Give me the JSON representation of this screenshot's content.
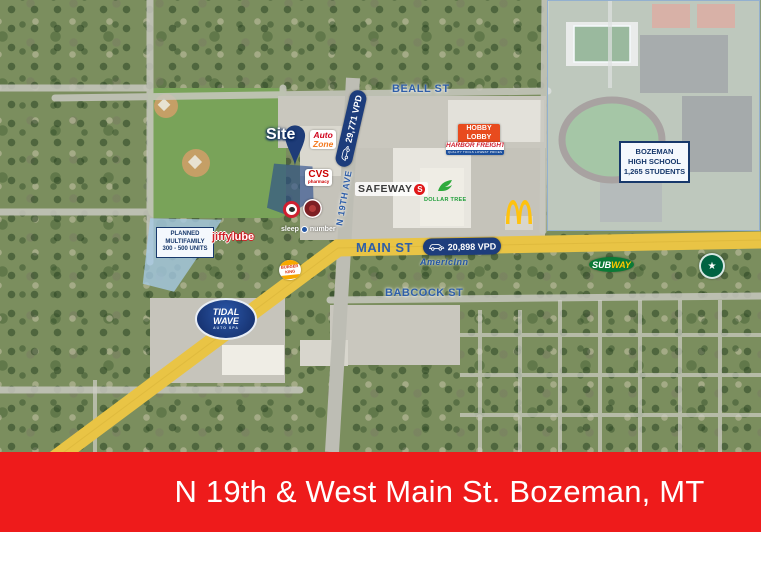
{
  "banner": {
    "title": "N 19th & West Main St. Bozeman, MT"
  },
  "streets": {
    "beall": "BEALL ST",
    "main": "MAIN ST",
    "babcock": "BABCOCK ST",
    "n19th": "N 19TH AVE"
  },
  "traffic": {
    "n19th_vpd": "29,771 VPD",
    "main_vpd": "20,898 VPD"
  },
  "site": {
    "label": "Site"
  },
  "callouts": {
    "multifamily": {
      "line1": "PLANNED",
      "line2": "MULTIFAMILY",
      "line3": "300 - 500 UNITS"
    },
    "high_school": {
      "line1": "BOZEMAN",
      "line2": "HIGH SCHOOL",
      "line3": "1,265 STUDENTS"
    }
  },
  "logos": {
    "autozone": {
      "top": "Auto",
      "bottom": "Zone"
    },
    "cvs": {
      "top": "CVS",
      "bottom": "pharmacy"
    },
    "safeway": {
      "name": "SAFEWAY",
      "initial": "S"
    },
    "dollar_tree": {
      "name": "DOLLAR TREE"
    },
    "hobby_lobby": {
      "line1": "HOBBY",
      "line2": "LOBBY"
    },
    "harbor_freight": {
      "name": "HARBOR FREIGHT",
      "tagline": "QUALITY TOOLS  LOWEST PRICES"
    },
    "jiffy_lube": {
      "part1": "jiffy",
      "part2": "lube"
    },
    "sleep_number": {
      "part1": "sleep",
      "part2": "number"
    },
    "burger_king": {
      "line1": "BURGER",
      "line2": "KING"
    },
    "subway": {
      "part1": "SUB",
      "part2": "WAY"
    },
    "tidal_wave": {
      "line1": "TIDAL",
      "line2": "WAVE",
      "line3": "AUTO SPA"
    },
    "americinn": {
      "name": "AmericInn"
    }
  },
  "icons": {
    "traffic_badge": "car-icon",
    "site_marker": "map-pin-icon",
    "mcdonalds": "golden-arches-icon",
    "starbucks": "siren-circle-icon",
    "panda_express": "red-ring-restaurant-icon",
    "chipotle": "red-medallion-restaurant-icon",
    "dollar_tree": "green-tree-icon",
    "sleep_number": "blue-circle-icon"
  },
  "colors": {
    "banner_red": "#ee1b1b",
    "badge_navy": "#1d3d7c",
    "street_label_blue": "#2e5ea8",
    "road_yellow": "#e9c445",
    "site_navy": "#1e3c78",
    "highlight_blue": "#a7cbe7"
  }
}
